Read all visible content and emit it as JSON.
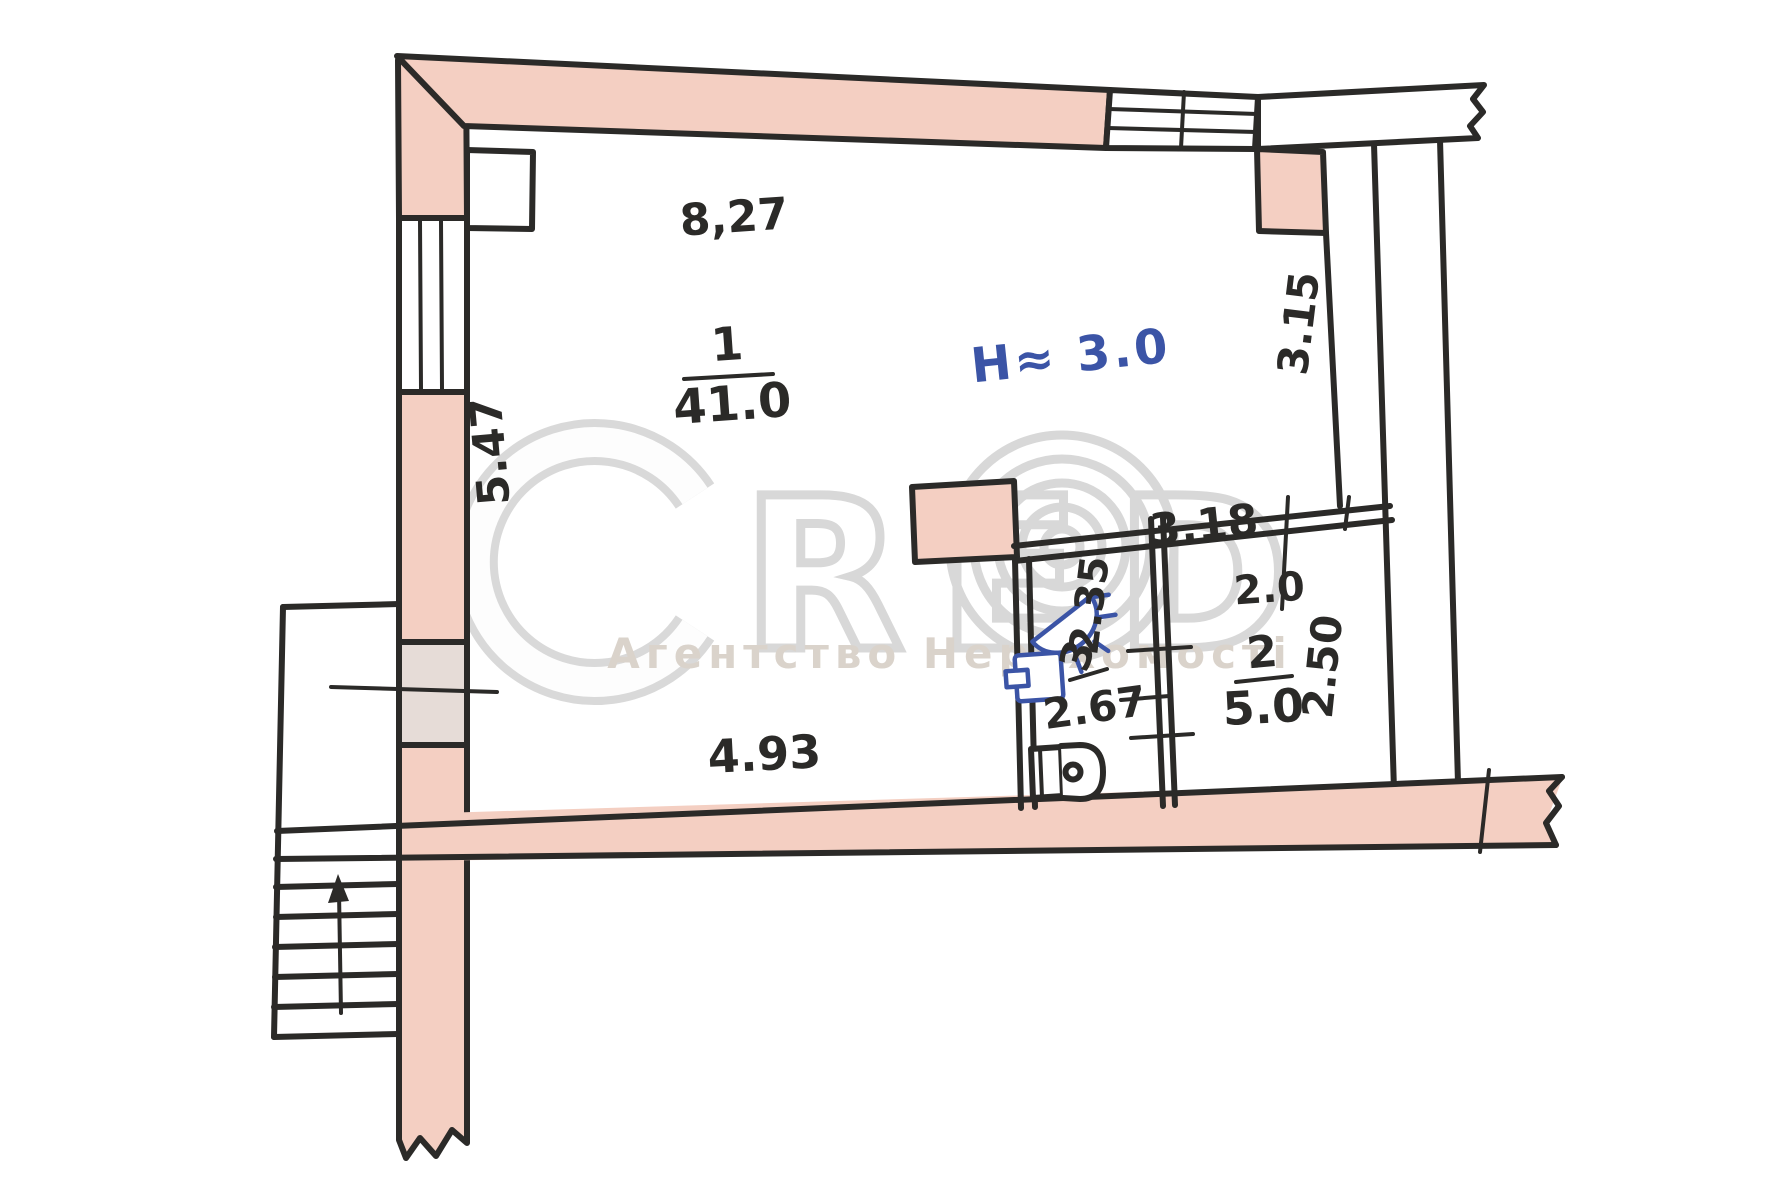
{
  "document": {
    "type": "hand-drawn floor plan scan",
    "colors": {
      "wall_fill": "#f4cfc2",
      "window_fill": "#e6dcd7",
      "ink": "#2b2a28",
      "blue_ink": "#3b54a6",
      "watermark_grey": "#d8d8d8"
    }
  },
  "watermark": {
    "letters": "RED",
    "subtitle": "Агентство Нерухомості"
  },
  "rooms": [
    {
      "number": "1",
      "area": "41.0"
    },
    {
      "number": "2",
      "area": "5.0"
    },
    {
      "number": "3",
      "area": ""
    }
  ],
  "annotations": {
    "height_note": "H≈ 3.0"
  },
  "dimensions": {
    "top_width": "8,27",
    "left_height": "5.47",
    "right_upper_height": "3.15",
    "partition_length": "3.18",
    "opening_width": "2.0",
    "bath_depth": "2.35",
    "bath_width": "2.67",
    "room2_depth": "2.50",
    "bottom_width": "4.93"
  }
}
